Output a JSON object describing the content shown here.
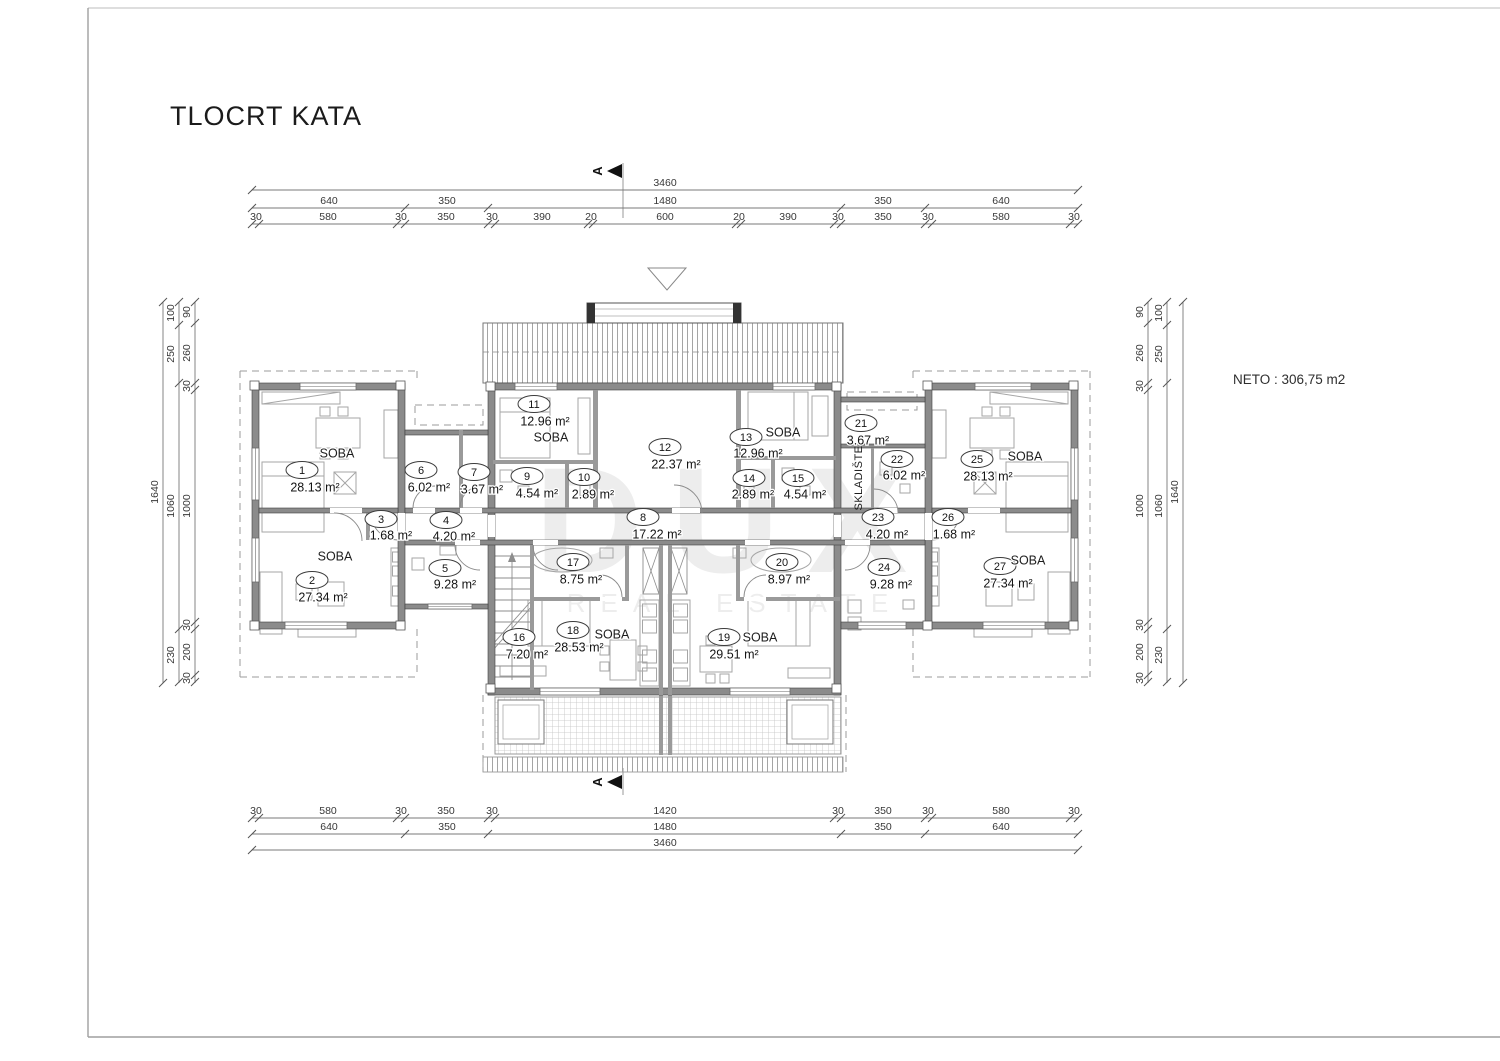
{
  "title": "TLOCRT KATA",
  "net_area_label": "NETO : 306,75 m2",
  "watermark": {
    "line1": "DUX",
    "line2": "REAL ESTATE"
  },
  "section_marker_letter": "A",
  "storage_room_label": "SKLADIŠTE",
  "rooms": [
    {
      "num": "1",
      "area": "28.13 m²",
      "tag": "SOBA"
    },
    {
      "num": "2",
      "area": "27.34 m²",
      "tag": "SOBA"
    },
    {
      "num": "3",
      "area": "1.68 m²",
      "tag": ""
    },
    {
      "num": "4",
      "area": "4.20 m²",
      "tag": ""
    },
    {
      "num": "5",
      "area": "9.28 m²",
      "tag": ""
    },
    {
      "num": "6",
      "area": "6.02 m²",
      "tag": ""
    },
    {
      "num": "7",
      "area": "3.67 m²",
      "tag": ""
    },
    {
      "num": "8",
      "area": "17.22 m²",
      "tag": ""
    },
    {
      "num": "9",
      "area": "4.54 m²",
      "tag": ""
    },
    {
      "num": "10",
      "area": "2.89 m²",
      "tag": ""
    },
    {
      "num": "11",
      "area": "12.96 m²",
      "tag": "SOBA"
    },
    {
      "num": "12",
      "area": "22.37 m²",
      "tag": ""
    },
    {
      "num": "13",
      "area": "12.96 m²",
      "tag": "SOBA"
    },
    {
      "num": "14",
      "area": "2.89 m²",
      "tag": ""
    },
    {
      "num": "15",
      "area": "4.54 m²",
      "tag": ""
    },
    {
      "num": "16",
      "area": "7.20 m²",
      "tag": ""
    },
    {
      "num": "17",
      "area": "8.75 m²",
      "tag": ""
    },
    {
      "num": "18",
      "area": "28.53 m²",
      "tag": "SOBA"
    },
    {
      "num": "19",
      "area": "29.51 m²",
      "tag": "SOBA"
    },
    {
      "num": "20",
      "area": "8.97 m²",
      "tag": ""
    },
    {
      "num": "21",
      "area": "3.67 m²",
      "tag": ""
    },
    {
      "num": "22",
      "area": "6.02 m²",
      "tag": ""
    },
    {
      "num": "23",
      "area": "4.20 m²",
      "tag": ""
    },
    {
      "num": "24",
      "area": "9.28 m²",
      "tag": ""
    },
    {
      "num": "25",
      "area": "28.13 m²",
      "tag": "SOBA"
    },
    {
      "num": "26",
      "area": "1.68 m²",
      "tag": ""
    },
    {
      "num": "27",
      "area": "27.34 m²",
      "tag": "SOBA"
    }
  ],
  "dims": {
    "top": {
      "total": "3460",
      "row2": [
        "640",
        "350",
        "1480",
        "350",
        "640"
      ],
      "row3": [
        "30",
        "580",
        "30",
        "350",
        "30",
        "390",
        "20",
        "600",
        "20",
        "390",
        "30",
        "350",
        "30",
        "580",
        "30"
      ]
    },
    "bottom": {
      "row1": [
        "30",
        "580",
        "30",
        "350",
        "30",
        "1420",
        "30",
        "350",
        "30",
        "580",
        "30"
      ],
      "row2": [
        "640",
        "350",
        "1480",
        "350",
        "640"
      ],
      "total": "3460"
    },
    "side": {
      "outer": "1640",
      "middle": [
        "100",
        "250",
        "1060",
        "230"
      ],
      "inner": [
        "90",
        "260",
        "30",
        "1000",
        "30",
        "200",
        "30"
      ]
    }
  }
}
